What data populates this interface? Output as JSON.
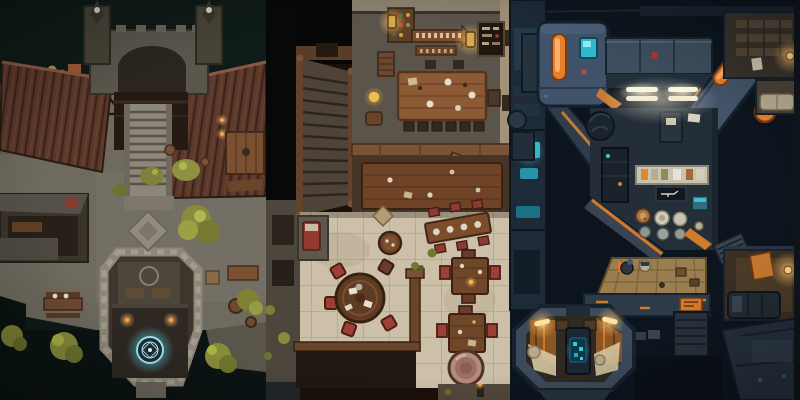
{
  "canvas": {
    "width": 800,
    "height": 400,
    "kind": "top-down-battle-map-triptych"
  },
  "panels": [
    {
      "id": "medieval-keep",
      "name": "medieval-keep-map",
      "style": "fantasy stone keep courtyard",
      "palette": {
        "background": "#0f1b18",
        "water": "#0a1413",
        "stone": "#6f6a5e",
        "roof": "#5a382a",
        "dais": "#b2ab9c",
        "tree": "#878c3a",
        "glow_cyan": "#9fe2ee",
        "torch_orange": "#ff9a3a"
      },
      "objects": [
        "plank-roof-left",
        "plank-roof-right",
        "gatehouse",
        "tower-spires",
        "descending-staircase",
        "stone-courtyard",
        "pale-dais-with-tree",
        "side-tables",
        "barrel-cluster",
        "collapsed-frame",
        "diamond-platform",
        "storage-buildings",
        "octagonal-ritual-chamber",
        "magic-circle",
        "torches",
        "bushes",
        "canal-water",
        "waterside-trees",
        "crates-and-barrels"
      ]
    },
    {
      "id": "tavern",
      "name": "tavern-interior-map",
      "style": "medieval tavern interior",
      "palette": {
        "upper_floor": "#5b544a",
        "wall_beige": "#a2927a",
        "table_wood": "#8d5a36",
        "tile_floor": "#cdc0a8",
        "tile_line": "#b2a58b",
        "chair_red": "#9c4036",
        "lantern_glow": "#ffce7a",
        "pot_copper": "#b68a7a",
        "dark_room": "#1f1710"
      },
      "objects": [
        "grand-staircase",
        "rune-sign-arrow",
        "hanging-lanterns",
        "menu-board",
        "bottle-shelf",
        "long-table-with-chairs",
        "lower-hall-table",
        "swinging-door",
        "tile-dining-floor",
        "round-table",
        "red-cushion-chairs",
        "keg-table",
        "diagonal-banquet-table",
        "square-table-a",
        "square-table-b",
        "copper-pot",
        "wooden-railing",
        "side-bed-nook",
        "stone-walkway"
      ]
    },
    {
      "id": "scifi-ship",
      "name": "scifi-ship-map",
      "style": "sci-fi spaceship interior",
      "palette": {
        "background": "#0c151e",
        "hull": "#41536a",
        "hull_dark": "#222f3c",
        "accent_orange": "#e5812e",
        "screen_cyan": "#2fb9cf",
        "light_warm": "#ffd98e",
        "platform_tan": "#9a7e50",
        "counter_pale": "#c9c3b1"
      },
      "objects": [
        "escape-pod-module",
        "orange-capsule-light",
        "cyan-status-screen",
        "side-turret",
        "corridor-bar",
        "ceiling-light-bars",
        "diagonal-strut",
        "orange-port-light",
        "storage-room-shelves",
        "warm-lamp",
        "workshop-room",
        "cable-spool",
        "workbench",
        "blueprint-display",
        "floor-plates",
        "maintenance-robots",
        "cargo-platform",
        "vent-panels",
        "hatch-circles",
        "crate-stack",
        "orange-poster",
        "bunk-room",
        "easel-lamp-room",
        "octagonal-pod-room",
        "pod-console",
        "pod-lamps",
        "hull-modules"
      ]
    }
  ]
}
